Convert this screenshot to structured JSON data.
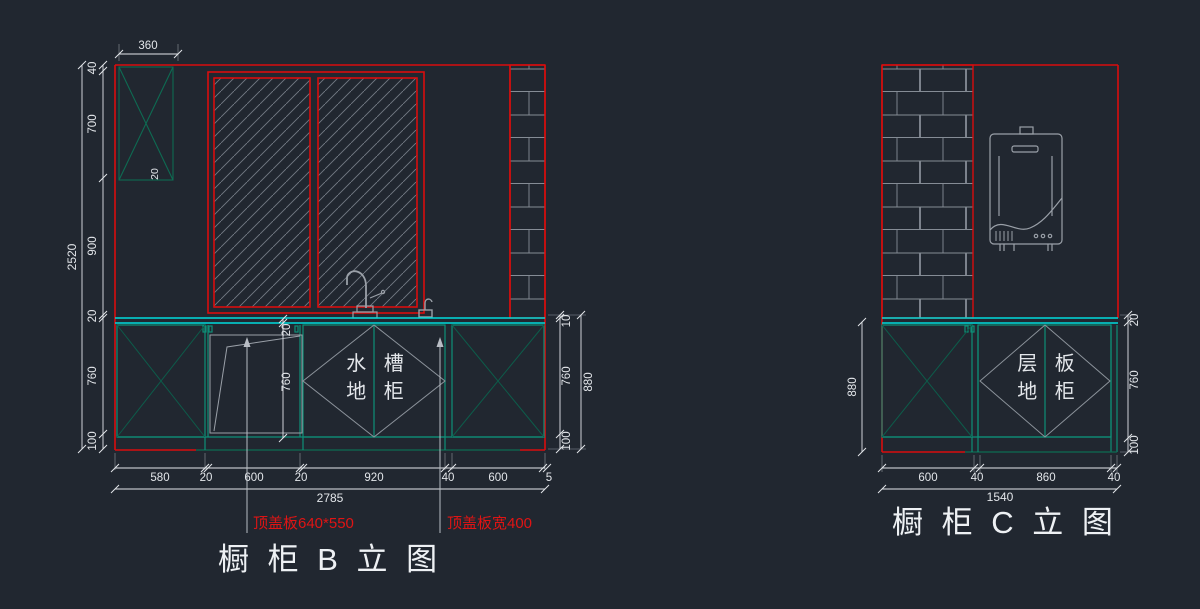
{
  "app": {
    "description": "橱柜立面图 CAD drawing",
    "background": "#212730"
  },
  "colors": {
    "outline_red": "#d90d0d",
    "countertop_cyan": "#00dcdc",
    "cabinet_teal": "#0e8f78",
    "cross_green": "#0d5c4a",
    "hatch_gray": "#737a84",
    "dim_white": "#e3e6ea",
    "annotation_red": "#e01414"
  },
  "b": {
    "title": "橱 柜 B 立 图",
    "top_width": "360",
    "panel_thickness": "20",
    "left_chain": [
      "40",
      "700",
      "900",
      "20",
      "760",
      "100"
    ],
    "left_total": "2520",
    "right_chain": [
      "10",
      "760",
      "100"
    ],
    "right_total": "880",
    "door_chain": [
      "20",
      "760"
    ],
    "bottom_chain": [
      "580",
      "20",
      "600",
      "20",
      "920",
      "40",
      "600",
      "5"
    ],
    "bottom_total": "2785",
    "sink_label_line1": "水 槽",
    "sink_label_line2": "地 柜",
    "note_left": "顶盖板640*550",
    "note_right": "顶盖板宽400"
  },
  "c": {
    "title": "橱 柜 C 立 图",
    "left_total": "880",
    "right_chain": [
      "20",
      "760",
      "100"
    ],
    "bottom_chain": [
      "600",
      "40",
      "860",
      "40"
    ],
    "bottom_total": "1540",
    "shelf_label_line1": "层 板",
    "shelf_label_line2": "地 柜"
  }
}
